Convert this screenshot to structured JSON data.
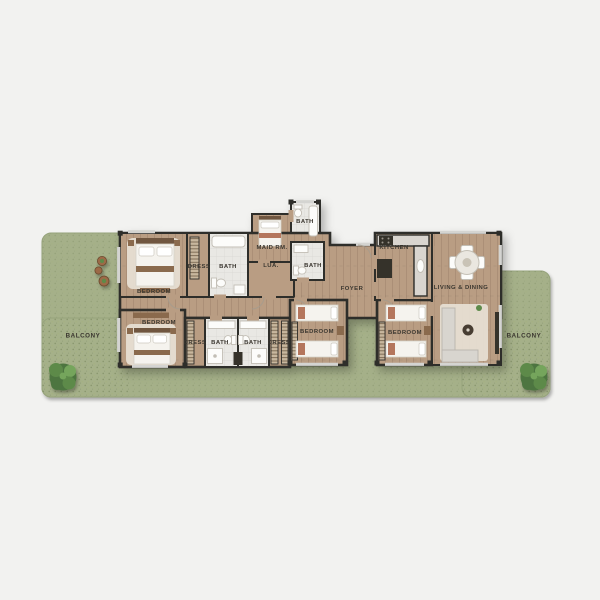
{
  "page": {
    "background_color": "#f2f2f0"
  },
  "floor_plan": {
    "type": "residential-apartment-floor-plan-top-view",
    "labels": {
      "bedroom_1": "BEDROOM",
      "bedroom_2": "BEDROOM",
      "bedroom_3": "BEDROOM",
      "bedroom_4": "BEDROOM",
      "dress_1": "DRESS",
      "dress_2": "DRESS",
      "dress_3": "DRESS",
      "bath_1": "BATH",
      "bath_2": "BATH",
      "bath_3": "BATH",
      "bath_4": "BATH",
      "bath_5": "BATH",
      "maid_room": "MAID RM.",
      "laundry": "LUA.",
      "foyer": "FOYER",
      "kitchen": "KITCHEN",
      "living_dining": "LIVING & DINING",
      "balcony_left": "BALCONY",
      "balcony_right": "BALCONY"
    },
    "colors": {
      "background": "#f2f2f0",
      "wall": "#2e2d2b",
      "wood": "#b99d83",
      "tile": "#e9e8e4",
      "grass": "#a5b089",
      "grass_edge": "#96a37b",
      "tree": "#4d7540",
      "tree_mid": "#5d8a4a",
      "tree_light": "#74a55c",
      "rug": "#e7e1d5",
      "white_furniture": "#f5f3ee",
      "accent_terracotta": "#b4765d",
      "counter": "#d9d5cf",
      "headboard": "#6f563f",
      "bench_wood": "#8a6a4e",
      "dark_furniture": "#343029",
      "planter": "#9c6b46",
      "window": "#d4d4d1",
      "text": "#3a362f"
    },
    "icons": {
      "tree": "circle-cluster-shape",
      "planter": "circle-shape",
      "dining_table": "circle-with-chairs-shape",
      "bed": "rect-with-pillows-shape"
    }
  }
}
